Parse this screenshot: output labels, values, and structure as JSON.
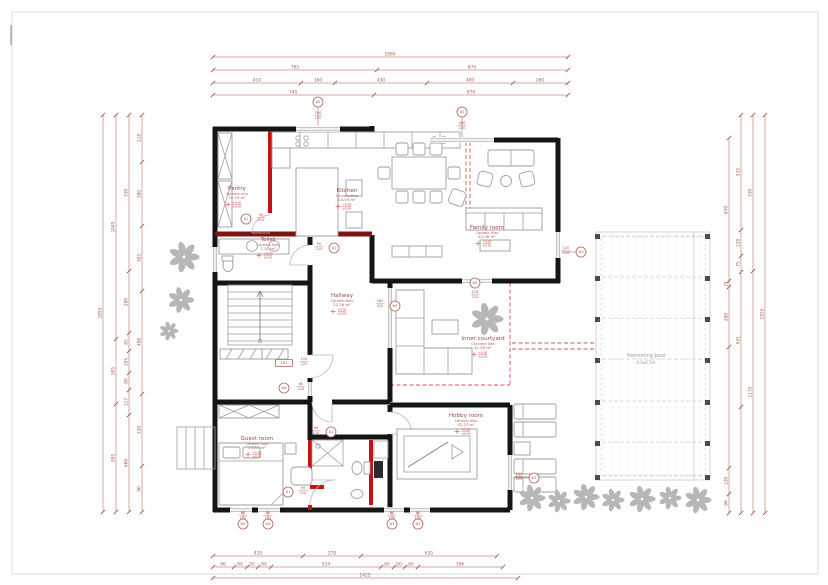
{
  "levels": {
    "top": "+0.00",
    "bottom": "±0.00"
  },
  "rooms": [
    {
      "name": "Pantry",
      "material": "Ceramic tiles",
      "area": "12.19 m²",
      "x": 237,
      "y": 190
    },
    {
      "name": "Kitchen",
      "material": "Ceramic tiles",
      "area": "24.49 m²",
      "x": 347,
      "y": 192
    },
    {
      "name": "Toilet",
      "material": "Ceramic tiles",
      "area": "7.31 m²",
      "x": 268,
      "y": 241
    },
    {
      "name": "Family room",
      "material": "Ceramic tiles",
      "area": "52.96 m²",
      "x": 487,
      "y": 229
    },
    {
      "name": "Hallway",
      "material": "Ceramic tiles",
      "area": "22.28 m²",
      "x": 342,
      "y": 297
    },
    {
      "name": "Inner courtyard",
      "material": "Concrete tiles",
      "area": "41.50 m²",
      "x": 483,
      "y": 340
    },
    {
      "name": "Guest room",
      "material": "Ceramic tiles",
      "area": "23.81 m²",
      "x": 257,
      "y": 440
    },
    {
      "name": "Hobby room",
      "material": "Ceramic tiles",
      "area": "32.27 m²",
      "x": 466,
      "y": 417
    }
  ],
  "pool": {
    "name": "Swimming pool",
    "size": "4.0x8.5m"
  },
  "tags": [
    {
      "label": "W1",
      "x": 318,
      "y": 102,
      "dims": [
        "160",
        "220"
      ],
      "dx": 318,
      "dy": 114,
      "leader": [
        318,
        107,
        318,
        126
      ]
    },
    {
      "label": "W2",
      "x": 462,
      "y": 112,
      "dims": [
        "400",
        "220"
      ],
      "dx": 462,
      "dy": 124,
      "leader": [
        462,
        117,
        462,
        137
      ]
    },
    {
      "label": "W3",
      "x": 581,
      "y": 252,
      "dims": [
        "120",
        "220"
      ],
      "dx": 566,
      "dy": 249,
      "leader": [
        576,
        252,
        561,
        252
      ]
    },
    {
      "label": "W4",
      "x": 395,
      "y": 306,
      "dims": [
        "280",
        "220"
      ],
      "dx": 380,
      "dy": 302
    },
    {
      "label": "W4",
      "x": 475,
      "y": 283,
      "dims": [
        "120",
        "220"
      ],
      "dx": 475,
      "dy": 293
    },
    {
      "label": "W3",
      "x": 534,
      "y": 478,
      "dims": [
        "120",
        "200"
      ],
      "dx": 519,
      "dy": 475,
      "leader": [
        529,
        478,
        513,
        478
      ]
    },
    {
      "label": "W5",
      "x": 243,
      "y": 524,
      "dims": [
        "60",
        "120"
      ],
      "dx": 243,
      "dy": 514,
      "leader": [
        243,
        519,
        243,
        512
      ]
    },
    {
      "label": "W5",
      "x": 268,
      "y": 524,
      "dims": [
        "60",
        "120"
      ],
      "dx": 268,
      "dy": 514,
      "leader": [
        268,
        519,
        268,
        512
      ]
    },
    {
      "label": "W5",
      "x": 392,
      "y": 524,
      "dims": [
        "60",
        "120"
      ],
      "dx": 392,
      "dy": 514,
      "leader": [
        392,
        519,
        392,
        512
      ]
    },
    {
      "label": "W5",
      "x": 418,
      "y": 524,
      "dims": [
        "60",
        "120"
      ],
      "dx": 418,
      "dy": 514,
      "leader": [
        418,
        519,
        418,
        512
      ]
    },
    {
      "label": "W6",
      "x": 284,
      "y": 388,
      "dims": [
        "60",
        "120"
      ],
      "dx": 301,
      "dy": 385
    },
    {
      "label": "ED1",
      "x": 284,
      "y": 363,
      "dims": [
        "100",
        "220"
      ],
      "dx": 304,
      "dy": 360,
      "box": true
    },
    {
      "label": "D1",
      "x": 246,
      "y": 219,
      "dims": [
        "90",
        "210"
      ],
      "dx": 261,
      "dy": 216
    },
    {
      "label": "D1",
      "x": 334,
      "y": 248,
      "dims": [
        "90",
        "210"
      ],
      "dx": 319,
      "dy": 245
    },
    {
      "label": "D1",
      "x": 331,
      "y": 432,
      "dims": [
        "90",
        "210"
      ],
      "dx": 316,
      "dy": 429
    },
    {
      "label": "D1",
      "x": 288,
      "y": 492,
      "dims": [
        "90",
        "210"
      ],
      "dx": 303,
      "dy": 489
    }
  ],
  "dim_chains": [
    {
      "o": "h",
      "y": 57,
      "a": 213,
      "b": 568,
      "ticks": [
        213,
        568
      ],
      "labels": [
        {
          "t": "1660",
          "p": 390
        }
      ]
    },
    {
      "o": "h",
      "y": 70,
      "a": 213,
      "b": 568,
      "ticks": [
        213,
        377,
        568
      ],
      "labels": [
        {
          "t": "765",
          "p": 295
        },
        {
          "t": "870",
          "p": 472
        }
      ]
    },
    {
      "o": "h",
      "y": 83,
      "a": 213,
      "b": 568,
      "ticks": [
        213,
        301,
        335,
        427,
        513,
        568
      ],
      "labels": [
        {
          "t": "410",
          "p": 257
        },
        {
          "t": "160",
          "p": 318
        },
        {
          "t": "430",
          "p": 381
        },
        {
          "t": "400",
          "p": 470
        },
        {
          "t": "260",
          "p": 540
        }
      ]
    },
    {
      "o": "h",
      "y": 95,
      "a": 213,
      "b": 568,
      "ticks": [
        213,
        374,
        568
      ],
      "labels": [
        {
          "t": "740",
          "p": 293
        },
        {
          "t": "870",
          "p": 471
        }
      ]
    },
    {
      "o": "h",
      "y": 556,
      "a": 213,
      "b": 497,
      "ticks": [
        213,
        303,
        361,
        497
      ],
      "labels": [
        {
          "t": "420",
          "p": 258
        },
        {
          "t": "270",
          "p": 332
        },
        {
          "t": "635",
          "p": 429
        }
      ]
    },
    {
      "o": "h",
      "y": 567,
      "a": 213,
      "b": 503,
      "ticks": [
        213,
        234,
        247,
        258,
        271,
        381,
        394,
        405,
        418,
        503
      ],
      "labels": [
        {
          "t": "96",
          "p": 223
        },
        {
          "t": "60",
          "p": 240
        },
        {
          "t": "50",
          "p": 252
        },
        {
          "t": "60",
          "p": 264
        },
        {
          "t": "514",
          "p": 326
        },
        {
          "t": "60",
          "p": 387
        },
        {
          "t": "50",
          "p": 399
        },
        {
          "t": "60",
          "p": 411
        },
        {
          "t": "396",
          "p": 460
        }
      ]
    },
    {
      "o": "h",
      "y": 578,
      "a": 213,
      "b": 518,
      "ticks": [
        213,
        518
      ],
      "labels": [
        {
          "t": "1425",
          "p": 365
        }
      ]
    },
    {
      "o": "v",
      "x": 103,
      "a": 115,
      "b": 512,
      "ticks": [
        115,
        512
      ],
      "labels": [
        {
          "t": "1855",
          "p": 313
        }
      ]
    },
    {
      "o": "v",
      "x": 116,
      "a": 115,
      "b": 512,
      "ticks": [
        115,
        339,
        404,
        512
      ],
      "labels": [
        {
          "t": "1045",
          "p": 227
        },
        {
          "t": "305",
          "p": 371
        },
        {
          "t": "505",
          "p": 458
        }
      ]
    },
    {
      "o": "v",
      "x": 129,
      "a": 115,
      "b": 512,
      "ticks": [
        115,
        271,
        333,
        351,
        373,
        390,
        415,
        512
      ],
      "labels": [
        {
          "t": "730",
          "p": 193
        },
        {
          "t": "290",
          "p": 302
        },
        {
          "t": "85",
          "p": 342
        },
        {
          "t": "105",
          "p": 362
        },
        {
          "t": "80",
          "p": 381
        },
        {
          "t": "117",
          "p": 402
        },
        {
          "t": "460",
          "p": 463
        }
      ]
    },
    {
      "o": "v",
      "x": 142,
      "a": 115,
      "b": 512,
      "ticks": [
        115,
        162,
        226,
        291,
        394,
        466,
        512
      ],
      "labels": [
        {
          "t": "218",
          "p": 138
        },
        {
          "t": "300",
          "p": 194
        },
        {
          "t": "305",
          "p": 258
        },
        {
          "t": "480",
          "p": 342
        },
        {
          "t": "338",
          "p": 430
        },
        {
          "t": "90",
          "p": 489
        }
      ]
    },
    {
      "o": "v",
      "x": 729,
      "a": 138,
      "b": 513,
      "ticks": [
        138,
        281,
        287,
        347,
        468,
        494,
        513
      ],
      "labels": [
        {
          "t": "670",
          "p": 210
        },
        {
          "t": "25",
          "p": 284
        },
        {
          "t": "280",
          "p": 317
        },
        {
          "t": "120",
          "p": 481
        },
        {
          "t": "90",
          "p": 503
        }
      ]
    },
    {
      "o": "v",
      "x": 741,
      "a": 115,
      "b": 513,
      "ticks": [
        115,
        230,
        256,
        272,
        407,
        513
      ],
      "labels": [
        {
          "t": "535",
          "p": 172
        },
        {
          "t": "120",
          "p": 243
        },
        {
          "t": "75",
          "p": 264
        },
        {
          "t": "631",
          "p": 340
        }
      ]
    },
    {
      "o": "v",
      "x": 753,
      "a": 115,
      "b": 513,
      "ticks": [
        115,
        271,
        513
      ],
      "labels": [
        {
          "t": "730",
          "p": 193
        },
        {
          "t": "1135",
          "p": 392
        }
      ]
    },
    {
      "o": "v",
      "x": 765,
      "a": 115,
      "b": 513,
      "ticks": [
        115,
        513
      ],
      "labels": [
        {
          "t": "1855",
          "p": 314
        }
      ]
    }
  ],
  "windows": [
    {
      "o": "h",
      "x": 296,
      "y": 129,
      "len": 44
    },
    {
      "o": "h",
      "x": 430,
      "y": 140,
      "len": 64
    },
    {
      "o": "v",
      "x": 558,
      "y": 232,
      "len": 26
    },
    {
      "o": "v",
      "x": 215,
      "y": 247,
      "len": 25
    },
    {
      "o": "v",
      "x": 390,
      "y": 288,
      "len": 60
    },
    {
      "o": "v",
      "x": 310,
      "y": 382,
      "len": 14
    },
    {
      "o": "v",
      "x": 510,
      "y": 455,
      "len": 35
    },
    {
      "o": "h",
      "x": 462,
      "y": 281,
      "len": 30
    },
    {
      "o": "h",
      "x": 230,
      "y": 510,
      "len": 22
    },
    {
      "o": "h",
      "x": 258,
      "y": 510,
      "len": 22
    },
    {
      "o": "h",
      "x": 384,
      "y": 510,
      "len": 20
    },
    {
      "o": "h",
      "x": 410,
      "y": 510,
      "len": 20
    }
  ],
  "plants": [
    {
      "x": 184,
      "y": 257,
      "s": 0.8
    },
    {
      "x": 181,
      "y": 300,
      "s": 0.68
    },
    {
      "x": 169,
      "y": 331,
      "s": 0.5
    },
    {
      "x": 487,
      "y": 319,
      "s": 0.85
    },
    {
      "x": 532,
      "y": 498,
      "s": 0.7
    },
    {
      "x": 559,
      "y": 501,
      "s": 0.6
    },
    {
      "x": 586,
      "y": 497,
      "s": 0.7
    },
    {
      "x": 613,
      "y": 500,
      "s": 0.6
    },
    {
      "x": 642,
      "y": 499,
      "s": 0.7
    },
    {
      "x": 670,
      "y": 498,
      "s": 0.6
    },
    {
      "x": 698,
      "y": 500,
      "s": 0.7
    }
  ]
}
